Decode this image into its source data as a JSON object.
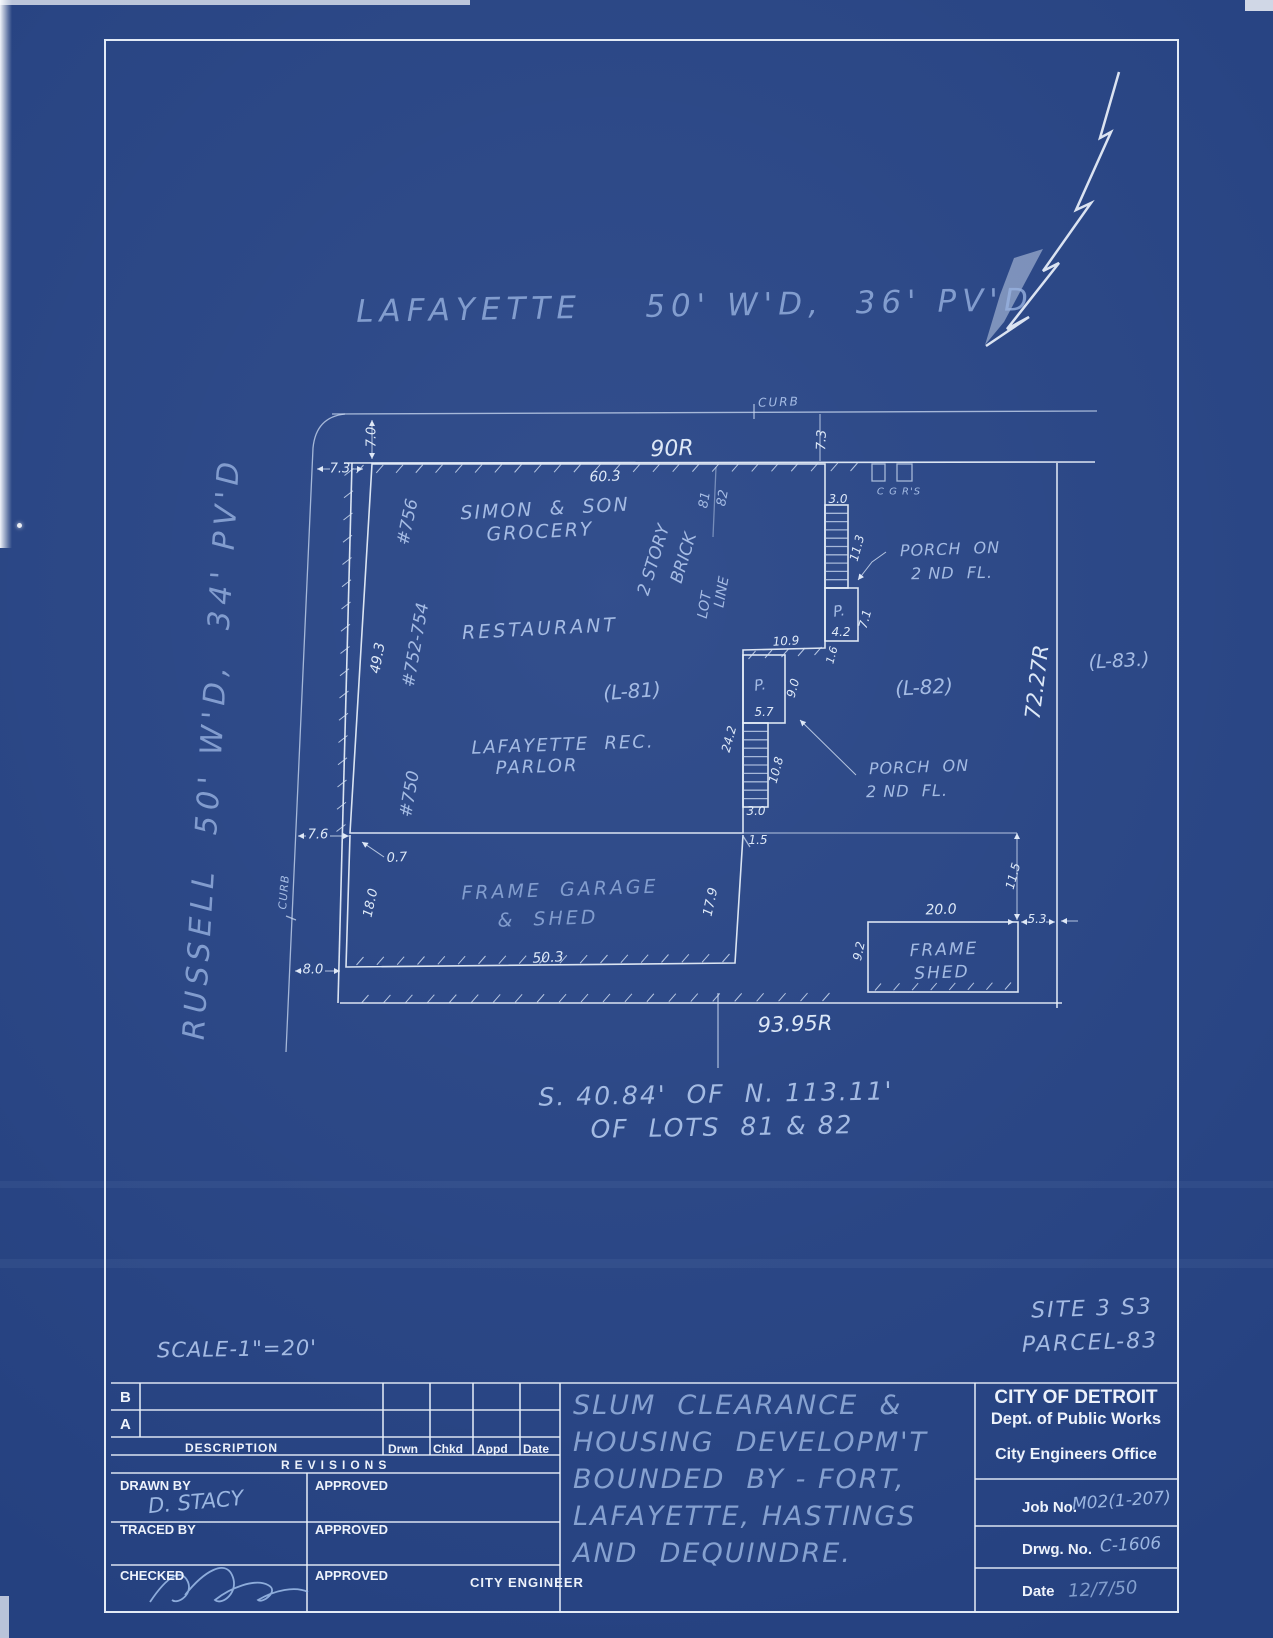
{
  "plan": {
    "texts": [
      {
        "n": "street-lafayette",
        "t": "LAFAYETTE    50' W'D,  36' PV'D",
        "x": 695,
        "y": 306,
        "r": -1,
        "s": 31,
        "c": "t-faint",
        "ls": 6
      },
      {
        "n": "street-russell",
        "t": "RUSSELL  50' W'D,  34' PV'D",
        "x": 212,
        "y": 748,
        "r": -86.5,
        "s": 30,
        "c": "t-faint",
        "ls": 6
      },
      {
        "n": "curb-label-top",
        "t": "CURB",
        "x": 779,
        "y": 402,
        "r": -2,
        "s": 12,
        "c": "t-med",
        "ls": 2
      },
      {
        "n": "curb-label-left",
        "t": "CURB",
        "x": 284,
        "y": 892,
        "r": -85,
        "s": 11,
        "c": "t-med",
        "ls": 1
      },
      {
        "n": "dim-90r",
        "t": "90R",
        "x": 672,
        "y": 449,
        "r": -2,
        "s": 22,
        "c": "t-bright"
      },
      {
        "n": "dim-60-3",
        "t": "60.3",
        "x": 605,
        "y": 477,
        "r": -2,
        "s": 14,
        "c": "t-bright"
      },
      {
        "n": "dim-72-27r",
        "t": "72.27R",
        "x": 1037,
        "y": 682,
        "r": -83,
        "s": 21,
        "c": "t-bright"
      },
      {
        "n": "dim-93-95r",
        "t": "93.95R",
        "x": 795,
        "y": 1024,
        "r": -2,
        "s": 21,
        "c": "t-bright"
      },
      {
        "n": "dim-7-3-left",
        "t": "7.3",
        "x": 340,
        "y": 469,
        "r": 0,
        "s": 13,
        "c": "t-bright"
      },
      {
        "n": "dim-7-0",
        "t": "7.0",
        "x": 372,
        "y": 437,
        "r": -90,
        "s": 13,
        "c": "t-bright"
      },
      {
        "n": "dim-7-3-right",
        "t": "7.3",
        "x": 822,
        "y": 440,
        "r": -88,
        "s": 13,
        "c": "t-bright"
      },
      {
        "n": "address-756",
        "t": "#756",
        "x": 408,
        "y": 522,
        "r": -78,
        "s": 17,
        "c": "t-med"
      },
      {
        "n": "address-752-754",
        "t": "#752-754",
        "x": 416,
        "y": 645,
        "r": -80,
        "s": 17,
        "c": "t-med"
      },
      {
        "n": "dim-49-3",
        "t": "49.3",
        "x": 378,
        "y": 658,
        "r": -80,
        "s": 14,
        "c": "t-bright"
      },
      {
        "n": "address-750",
        "t": "#750",
        "x": 410,
        "y": 794,
        "r": -80,
        "s": 17,
        "c": "t-med"
      },
      {
        "n": "bldg-simon-son",
        "t": "SIMON  &  SON",
        "x": 545,
        "y": 509,
        "r": -3,
        "s": 19,
        "c": "t-med",
        "ls": 2
      },
      {
        "n": "bldg-grocery",
        "t": "GROCERY",
        "x": 540,
        "y": 532,
        "r": -3,
        "s": 19,
        "c": "t-med",
        "ls": 2
      },
      {
        "n": "bldg-restaurant",
        "t": "RESTAURANT",
        "x": 540,
        "y": 629,
        "r": -3,
        "s": 19,
        "c": "t-med",
        "ls": 3
      },
      {
        "n": "lot-l81",
        "t": "(L-81)",
        "x": 632,
        "y": 691,
        "r": -4,
        "s": 20,
        "c": "t-med"
      },
      {
        "n": "bldg-lafayette-rec",
        "t": "LAFAYETTE  REC.",
        "x": 563,
        "y": 745,
        "r": -2,
        "s": 18,
        "c": "t-med",
        "ls": 2
      },
      {
        "n": "bldg-parlor",
        "t": "PARLOR",
        "x": 537,
        "y": 767,
        "r": -2,
        "s": 18,
        "c": "t-med",
        "ls": 2
      },
      {
        "n": "note-2story",
        "t": "2 STORY",
        "x": 654,
        "y": 560,
        "r": -73,
        "s": 17,
        "c": "t-med"
      },
      {
        "n": "note-brick",
        "t": "BRICK",
        "x": 684,
        "y": 558,
        "r": -73,
        "s": 17,
        "c": "t-med"
      },
      {
        "n": "lotline-lot",
        "t": "LOT",
        "x": 705,
        "y": 605,
        "r": -80,
        "s": 14,
        "c": "t-med"
      },
      {
        "n": "lotline-line",
        "t": "LINE",
        "x": 722,
        "y": 592,
        "r": -80,
        "s": 14,
        "c": "t-med"
      },
      {
        "n": "lotnum-81",
        "t": "81",
        "x": 705,
        "y": 500,
        "r": -80,
        "s": 13,
        "c": "t-med"
      },
      {
        "n": "lotnum-82",
        "t": "82",
        "x": 723,
        "y": 498,
        "r": -80,
        "s": 13,
        "c": "t-med"
      },
      {
        "n": "label-cgrs",
        "t": "C G R'S",
        "x": 899,
        "y": 492,
        "r": 0,
        "s": 10,
        "c": "t-med",
        "ls": 1
      },
      {
        "n": "porch1-text1",
        "t": "PORCH  ON",
        "x": 950,
        "y": 549,
        "r": -2,
        "s": 16,
        "c": "t-med",
        "ls": 1
      },
      {
        "n": "porch1-text2",
        "t": "2 ND  FL.",
        "x": 952,
        "y": 573,
        "r": -1,
        "s": 16,
        "c": "t-med",
        "ls": 1
      },
      {
        "n": "lot-l82",
        "t": "(L-82)",
        "x": 924,
        "y": 687,
        "r": -3,
        "s": 20,
        "c": "t-med"
      },
      {
        "n": "lot-l83",
        "t": "(L-83.)",
        "x": 1119,
        "y": 661,
        "r": -3,
        "s": 19,
        "c": "t-med"
      },
      {
        "n": "porch2-text1",
        "t": "PORCH  ON",
        "x": 919,
        "y": 767,
        "r": -2,
        "s": 16,
        "c": "t-med",
        "ls": 1
      },
      {
        "n": "porch2-text2",
        "t": "2 ND  FL.",
        "x": 907,
        "y": 791,
        "r": -1,
        "s": 16,
        "c": "t-med",
        "ls": 1
      },
      {
        "n": "porch1-p",
        "t": "P.",
        "x": 839,
        "y": 611,
        "r": -8,
        "s": 15,
        "c": "t-med"
      },
      {
        "n": "porch2-p",
        "t": "P.",
        "x": 760,
        "y": 685,
        "r": -8,
        "s": 15,
        "c": "t-med"
      },
      {
        "n": "dim-3-0-top",
        "t": "3.0",
        "x": 838,
        "y": 499,
        "r": 0,
        "s": 12,
        "c": "t-bright"
      },
      {
        "n": "dim-11-3",
        "t": "11.3",
        "x": 857,
        "y": 548,
        "r": -75,
        "s": 12,
        "c": "t-bright"
      },
      {
        "n": "dim-4-2",
        "t": "4.2",
        "x": 841,
        "y": 632,
        "r": 0,
        "s": 12,
        "c": "t-bright"
      },
      {
        "n": "dim-7-1",
        "t": "7.1",
        "x": 865,
        "y": 619,
        "r": -75,
        "s": 12,
        "c": "t-bright"
      },
      {
        "n": "dim-1-6",
        "t": "1.6",
        "x": 832,
        "y": 655,
        "r": -75,
        "s": 11,
        "c": "t-bright"
      },
      {
        "n": "dim-10-9",
        "t": "10.9",
        "x": 786,
        "y": 641,
        "r": -3,
        "s": 12,
        "c": "t-bright"
      },
      {
        "n": "dim-9-0",
        "t": "9.0",
        "x": 793,
        "y": 688,
        "r": -75,
        "s": 12,
        "c": "t-bright"
      },
      {
        "n": "dim-5-7",
        "t": "5.7",
        "x": 764,
        "y": 712,
        "r": 0,
        "s": 12,
        "c": "t-bright"
      },
      {
        "n": "dim-24-2",
        "t": "24.2",
        "x": 729,
        "y": 739,
        "r": -75,
        "s": 12,
        "c": "t-bright"
      },
      {
        "n": "dim-10-8",
        "t": "10.8",
        "x": 776,
        "y": 770,
        "r": -75,
        "s": 12,
        "c": "t-bright"
      },
      {
        "n": "dim-3-0-bottom",
        "t": "3.0",
        "x": 756,
        "y": 811,
        "r": 0,
        "s": 12,
        "c": "t-bright"
      },
      {
        "n": "dim-7-6",
        "t": "7.6",
        "x": 318,
        "y": 835,
        "r": 0,
        "s": 13,
        "c": "t-bright"
      },
      {
        "n": "dim-0-7",
        "t": "0.7",
        "x": 397,
        "y": 858,
        "r": -3,
        "s": 13,
        "c": "t-bright"
      },
      {
        "n": "dim-18-0",
        "t": "18.0",
        "x": 371,
        "y": 903,
        "r": -78,
        "s": 13,
        "c": "t-bright"
      },
      {
        "n": "dim-8-0",
        "t": "8.0",
        "x": 313,
        "y": 970,
        "r": 0,
        "s": 13,
        "c": "t-bright"
      },
      {
        "n": "bldg-frame-garage",
        "t": "FRAME  GARAGE",
        "x": 560,
        "y": 890,
        "r": -2,
        "s": 19,
        "c": "t-faint",
        "ls": 3
      },
      {
        "n": "bldg-and-shed",
        "t": "&  SHED",
        "x": 548,
        "y": 919,
        "r": -2,
        "s": 19,
        "c": "t-faint",
        "ls": 3
      },
      {
        "n": "dim-50-3",
        "t": "50.3",
        "x": 548,
        "y": 958,
        "r": -3,
        "s": 14,
        "c": "t-bright"
      },
      {
        "n": "dim-1-5",
        "t": "1.5",
        "x": 758,
        "y": 840,
        "r": 0,
        "s": 12,
        "c": "t-bright"
      },
      {
        "n": "dim-17-9",
        "t": "17.9",
        "x": 711,
        "y": 902,
        "r": -78,
        "s": 13,
        "c": "t-bright"
      },
      {
        "n": "dim-11-5",
        "t": "11.5",
        "x": 1013,
        "y": 876,
        "r": -75,
        "s": 12,
        "c": "t-bright"
      },
      {
        "n": "dim-20-0",
        "t": "20.0",
        "x": 941,
        "y": 910,
        "r": -2,
        "s": 14,
        "c": "t-bright"
      },
      {
        "n": "dim-5-3",
        "t": "5.3",
        "x": 1037,
        "y": 919,
        "r": 0,
        "s": 12,
        "c": "t-bright"
      },
      {
        "n": "dim-9-2",
        "t": "9.2",
        "x": 859,
        "y": 951,
        "r": -78,
        "s": 12,
        "c": "t-bright"
      },
      {
        "n": "bldg-frame-shed1",
        "t": "FRAME",
        "x": 944,
        "y": 950,
        "r": -2,
        "s": 17,
        "c": "t-med",
        "ls": 2
      },
      {
        "n": "bldg-frame-shed2",
        "t": "SHED",
        "x": 942,
        "y": 973,
        "r": -2,
        "s": 17,
        "c": "t-med",
        "ls": 2
      },
      {
        "n": "note-lots-line1",
        "t": "S. 40.84'  OF  N. 113.11'",
        "x": 716,
        "y": 1094,
        "r": -1,
        "s": 25,
        "c": "t-med",
        "ls": 2
      },
      {
        "n": "note-lots-line2",
        "t": "OF  LOTS  81 & 82",
        "x": 722,
        "y": 1127,
        "r": -1,
        "s": 25,
        "c": "t-med",
        "ls": 2
      },
      {
        "n": "scale-note",
        "t": "SCALE-1\"=20'",
        "x": 237,
        "y": 1349,
        "r": -1,
        "s": 21,
        "c": "t-med",
        "ls": 1
      },
      {
        "n": "site-number",
        "t": "SITE 3 S3",
        "x": 1092,
        "y": 1309,
        "r": -2,
        "s": 22,
        "c": "t-med",
        "ls": 2
      },
      {
        "n": "parcel-number",
        "t": "PARCEL-83",
        "x": 1090,
        "y": 1343,
        "r": -2,
        "s": 22,
        "c": "t-med",
        "ls": 2
      }
    ]
  },
  "titleblock": {
    "revisions": {
      "row_b": "B",
      "row_a": "A",
      "description": "DESCRIPTION",
      "col_drwn": "Drwn",
      "col_chkd": "Chkd",
      "col_appd": "Appd",
      "col_date": "Date",
      "title": "REVISIONS"
    },
    "signoff": {
      "drawn_by": "DRAWN BY",
      "drawn_by_value": "D. STACY",
      "traced_by": "TRACED BY",
      "checked": "CHECKED",
      "approved": "APPROVED",
      "city_engineer": "CITY ENGINEER"
    },
    "project_lines": [
      "SLUM  CLEARANCE  &",
      "HOUSING  DEVELOPM'T",
      "BOUNDED  BY - FORT,",
      "LAFAYETTE, HASTINGS",
      "AND  DEQUINDRE."
    ],
    "org": {
      "name": "CITY OF DETROIT",
      "dept": "Dept. of Public Works",
      "office": "City Engineers Office",
      "job_label": "Job No.",
      "job_value": "M02(1-207)",
      "drwg_label": "Drwg. No.",
      "drwg_value": "C-1606",
      "date_label": "Date",
      "date_value": "12/7/50"
    }
  }
}
